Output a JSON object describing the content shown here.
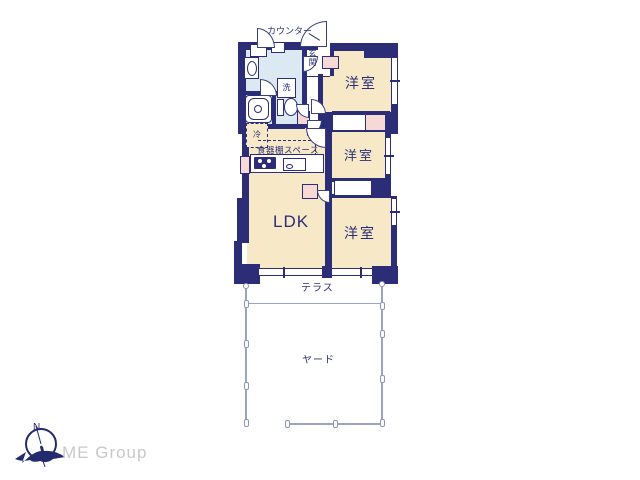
{
  "floorplan": {
    "labels": {
      "counter": "カウンター",
      "entrance": "玄関",
      "wash": "洗",
      "fridge": "冷",
      "cupboard_space": "食器棚スペース",
      "ldk": "LDK",
      "rooms": [
        "洋室",
        "洋室",
        "洋室"
      ],
      "terrace": "テラス",
      "yard": "ヤード"
    },
    "colors": {
      "wall": "#2b2e76",
      "room_floor": "#f7e8c7",
      "bathroom_floor": "#dce9f2",
      "closet": "#f6d9d4",
      "fence": "#9aa4c6",
      "label_text": "#2b2e76"
    }
  },
  "branding": {
    "company": "ME Group",
    "compass_north": "N",
    "logo_color": "#232a6d",
    "text_color": "#c9c9c9"
  }
}
